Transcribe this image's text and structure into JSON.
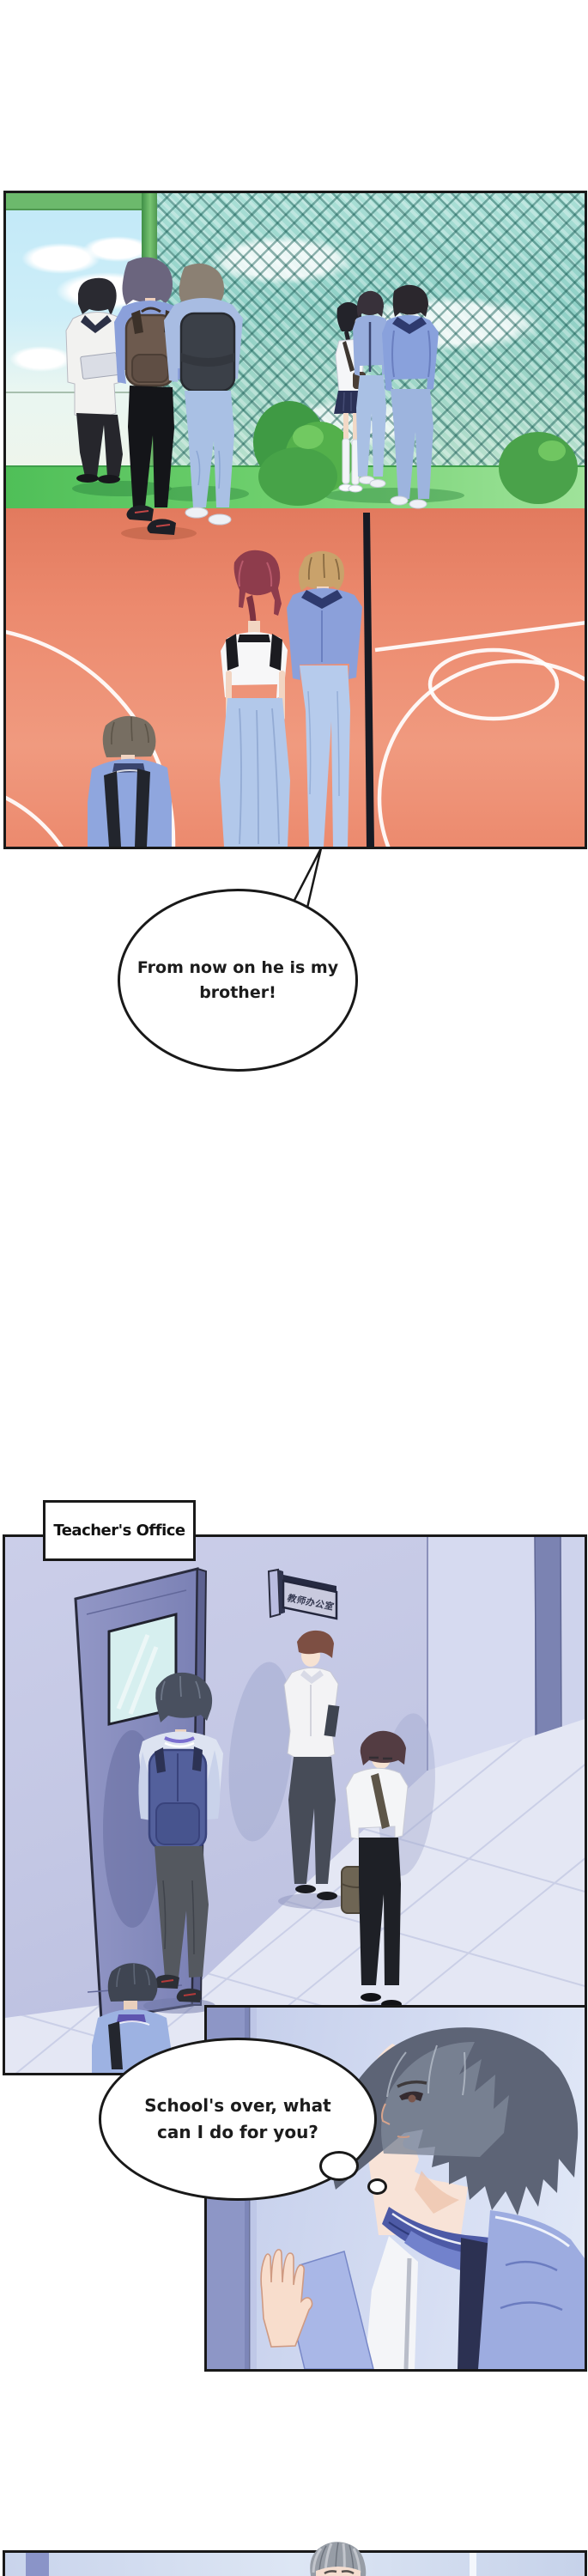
{
  "comic": {
    "speech_bubble": {
      "line1": "From now on he is my",
      "line2": "brother!"
    },
    "caption": {
      "text": "Teacher's Office"
    },
    "door_sign": {
      "text": "教师办公室"
    },
    "thought_bubble": {
      "line1": "School's over, what",
      "line2": "can I do for you?"
    }
  },
  "colors": {
    "ink": "#191919",
    "bubble-bg": "#ffffff",
    "court": "#ec8a6e",
    "grass": "#5cc463",
    "lattice": "#8fd0c6",
    "sky": "#c2e9f8",
    "frame-green": "#6cb96c",
    "wall": "#c3c7e4",
    "floor": "#e4e7f4",
    "door": "#868cbb",
    "uniform-blue": "#8ba0da",
    "backpack-navy": "#53609c",
    "vest-blue": "#8b9bd8",
    "hair-gray": "#979da6",
    "skin": "#f6e2d4"
  }
}
